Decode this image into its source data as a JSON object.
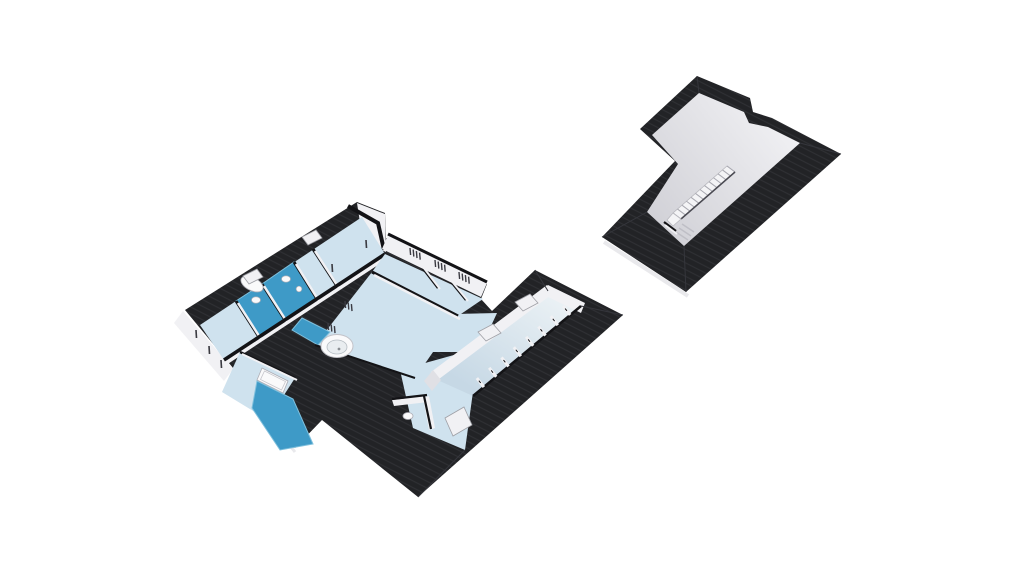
{
  "scene": {
    "background": "#ffffff",
    "description": "3D isometric floor plan rendering: main floor level (left) beside empty attic roof level (right)"
  },
  "colors": {
    "roofDark": "#222326",
    "roofStripe": "#2f3034",
    "capBlack": "#131316",
    "wallWhite": "#f1f1f4",
    "wallShade": "#c9c9cf",
    "floorLight": "#cfe2ee",
    "floorBath": "#3e9ac7",
    "floorBathEdge": "#7fc0dd",
    "eastFloorLight": "#e9f0f4",
    "eastFloorDark": "#c6d8e5",
    "atticFloorLight": "#f0f0f3",
    "atticFloorDark": "#cfcfd5",
    "fixtureWhite": "#fafafb",
    "fixtureStroke": "#aeaeb6",
    "windowSlit": "#3b3b42",
    "fascia": "#e9e9ec",
    "railWhite": "#f4f4f6",
    "railTick": "#a8a8b0",
    "railShadow": "#4a4a52",
    "hipLine": "#35363c"
  },
  "main_level": {
    "name": "main-floor-level",
    "skylights": 5,
    "bath_floor_patches": 4,
    "closet_partitions": 8,
    "ne_wall_slit_groups": 3,
    "inner_wall_slit_groups": 2,
    "west_window_slits": 3,
    "fixtures": [
      "round-jacuzzi",
      "corner-bathtub",
      "straight-bathtub",
      "toilet",
      "toilet",
      "sink",
      "closet-seat"
    ]
  },
  "attic_level": {
    "name": "attic-roof-level",
    "features": [
      "staircase-opening",
      "stair-railing",
      "steps"
    ],
    "railing_balusters": 13,
    "step_lines": 3
  }
}
